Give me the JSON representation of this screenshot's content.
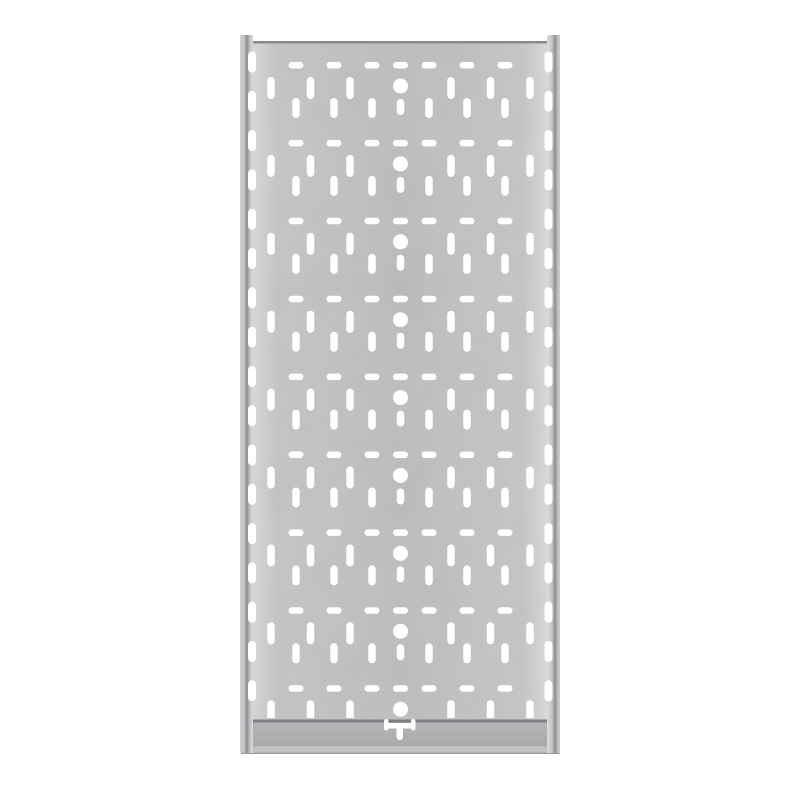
{
  "scene": {
    "width": 800,
    "height": 800,
    "background": "#ffffff",
    "subject": "galvanized-perforated-cable-tray-panel"
  },
  "colors": {
    "hole": "#ffffff",
    "face_edge_highlight": "#d9d9db",
    "face_near_edge": "#c5c5c7",
    "face_center": "#bdbdbf",
    "top_edge_line": "#8a8a8e",
    "bottom_edge_line": "#7e7e82",
    "band_top": "#b5b5b8",
    "band_bottom": "#a9a9ac",
    "band_lip": "#c1c1c4",
    "band_lip_edge": "#9a9a9e",
    "rail_outer_left": "#cfcfd2",
    "rail_mid_light": "#c4c4c7",
    "rail_dark": "#8e8e92",
    "rail_inner_bright": "#dcdcdf",
    "rail_outer_right": "#c9c9cc",
    "grain_fine_opacity": 0.1,
    "grain_coarse_opacity": 0.09
  },
  "panel": {
    "rail_left": {
      "x": 240,
      "y": 35,
      "w": 13,
      "h": 718
    },
    "rail_right": {
      "x": 547,
      "y": 35,
      "w": 13,
      "h": 718
    },
    "face": {
      "x": 253,
      "y": 41,
      "w": 294,
      "h": 681
    },
    "top_edge": {
      "x": 253,
      "y": 41,
      "w": 294,
      "h": 2.5
    },
    "bottom_edge": {
      "x": 248,
      "y": 719.5,
      "w": 304,
      "h": 3
    },
    "band": {
      "x": 241,
      "y": 722.5,
      "w": 319,
      "h": 23.5
    },
    "band_lip": {
      "x": 241,
      "y": 746,
      "w": 319,
      "h": 6.5
    },
    "band_lip_edge": {
      "x": 241,
      "y": 752.5,
      "w": 319,
      "h": 1.5
    }
  },
  "pattern": {
    "center_x": 400.5,
    "tile_height": 77.9,
    "first_row_y": 62,
    "row_count": 9,
    "clip": {
      "x": 236,
      "y": 43.5,
      "w": 330,
      "h": 674.5
    },
    "dashes": {
      "offsets": [
        -104.5,
        -66.5,
        -28.5,
        0,
        28.5,
        66.5,
        104.5
      ],
      "w": 15,
      "h": 6.5,
      "dy": 0
    },
    "upper_slots": {
      "offsets": [
        -129.5,
        -90,
        -50.5,
        50.5,
        90,
        129.5
      ],
      "w": 7.5,
      "h": 22,
      "dy": 15
    },
    "lower_slots": {
      "offsets": [
        -104.5,
        -66.5,
        -28.5,
        28.5,
        66.5,
        104.5
      ],
      "w": 7.5,
      "h": 20,
      "dy": 36
    },
    "center_hole": {
      "r": 7.5,
      "dy": 24
    },
    "center_slot": {
      "w": 7.5,
      "h": 16,
      "dy": 37
    },
    "fold_slots": {
      "left_cx": 252,
      "right_cx": 548.5,
      "w": 8,
      "h": 21,
      "first_cy": 62,
      "spacing": 39.3,
      "count": 17
    }
  },
  "bottom_detail": {
    "hooks": [
      {
        "x": 384,
        "y": 719,
        "w": 4.5,
        "h": 11.5
      },
      {
        "x": 411,
        "y": 719,
        "w": 4.5,
        "h": 11.5
      }
    ],
    "bar": {
      "x": 384,
      "y": 723,
      "w": 31.5,
      "h": 5.5
    },
    "stem": {
      "x": 396.5,
      "y": 726,
      "w": 6.5,
      "h": 14
    }
  }
}
